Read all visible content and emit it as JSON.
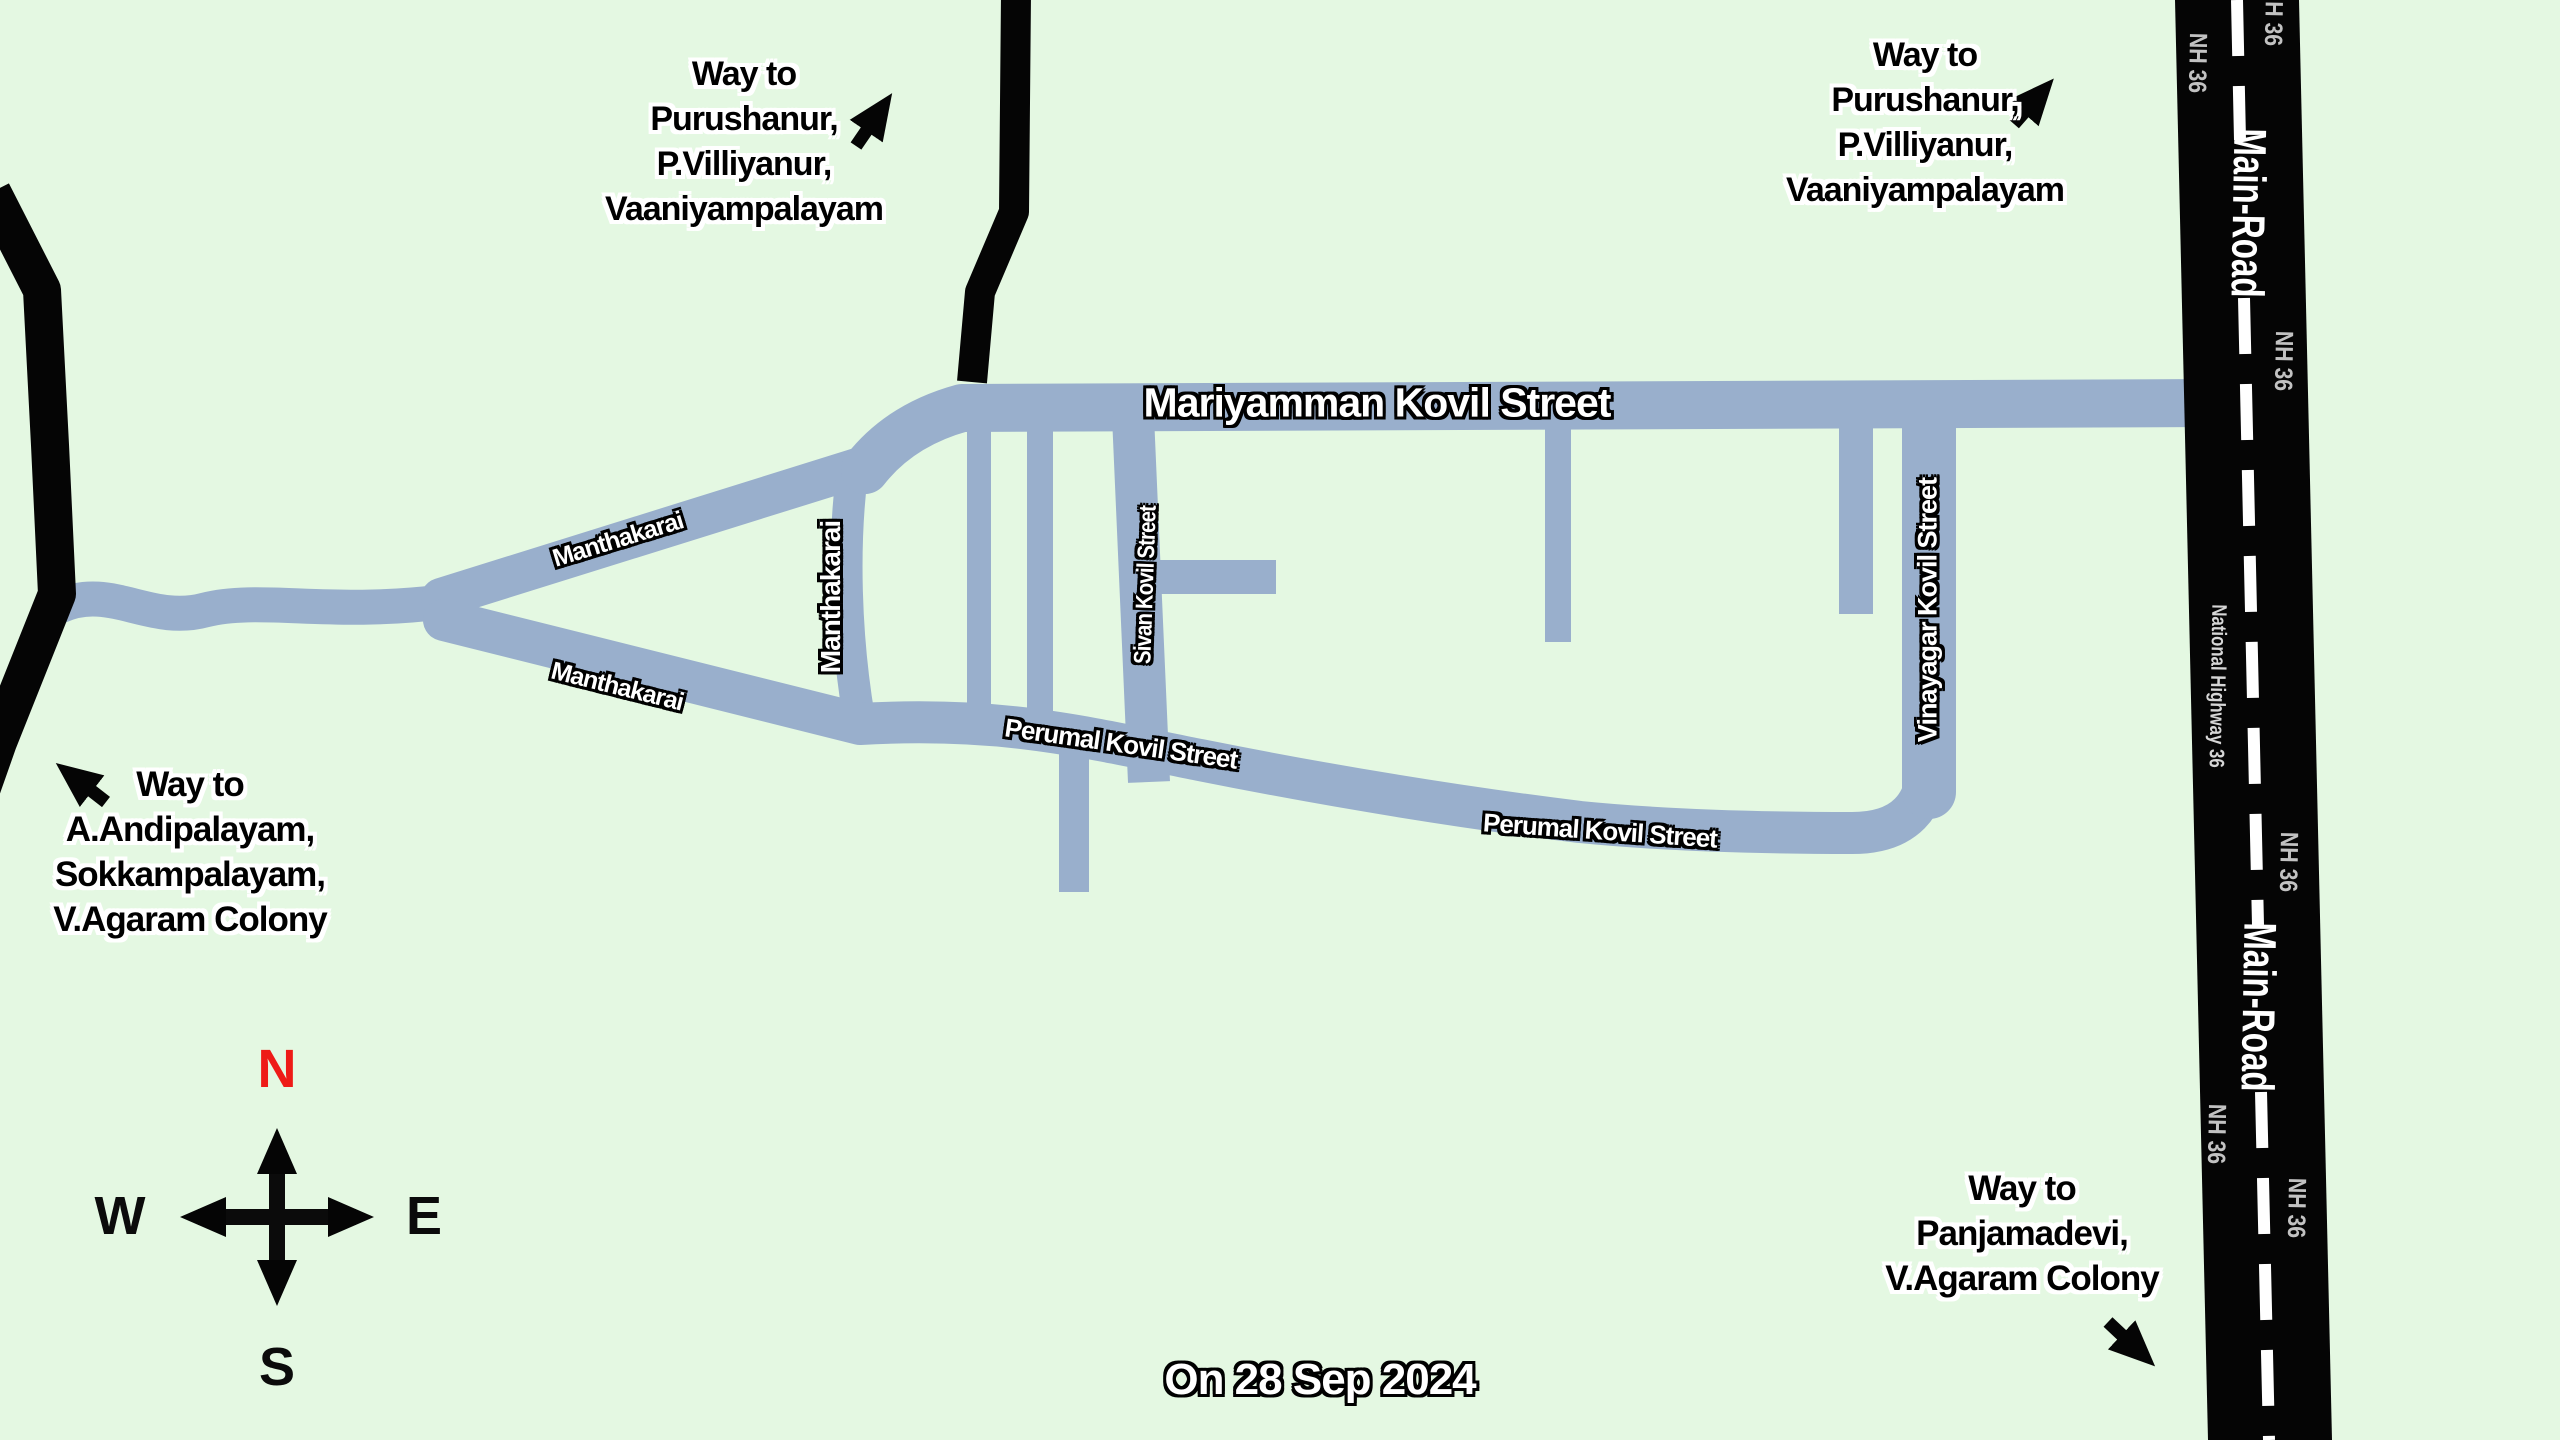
{
  "map_title": "Village street sketch map",
  "colors": {
    "background": "#e4f8e2",
    "street": "#99afcc",
    "highway_road": "#050505",
    "center_dash": "#ffffff",
    "street_label_fill": "#ffffff",
    "waypost_fill": "#000000",
    "nh_badge_text": "#c2c2c2",
    "compass_north": "#ee1b17"
  },
  "compass": {
    "north": "N",
    "east": "E",
    "south": "S",
    "west": "W"
  },
  "date_label": "On 28 Sep 2024",
  "streets": {
    "mariyamman": "Mariyamman Kovil Street",
    "manthakarai_upper": "Manthakarai",
    "manthakarai_lower": "Manthakarai",
    "manthakarai_vertical": "Manthakarai",
    "sivan": "Sivan Kovil Street",
    "perumal_west": "Perumal Kovil Street",
    "perumal_east": "Perumal Kovil Street",
    "vinayagar": "Vinayagar Kovil Street"
  },
  "highway": {
    "main_road_upper": "Main-Road",
    "main_road_lower": "Main-Road",
    "national_highway": "National Highway 36",
    "nh_badges": [
      "NH 36",
      "NH 36",
      "NH 36",
      "NH 36",
      "NH 36",
      "NH 36"
    ]
  },
  "wayposts": {
    "top_left": {
      "lines": [
        "Way to",
        "Purushanur,",
        "P.Villiyanur,",
        "Vaaniyampalayam"
      ]
    },
    "top_right": {
      "lines": [
        "Way to",
        "Purushanur,",
        "P.Villiyanur,",
        "Vaaniyampalayam"
      ]
    },
    "bottom_left": {
      "lines": [
        "Way to",
        "A.Andipalayam,",
        "Sokkampalayam,",
        "V.Agaram Colony"
      ]
    },
    "bottom_right": {
      "lines": [
        "Way to",
        "Panjamadevi,",
        "V.Agaram Colony"
      ]
    }
  }
}
